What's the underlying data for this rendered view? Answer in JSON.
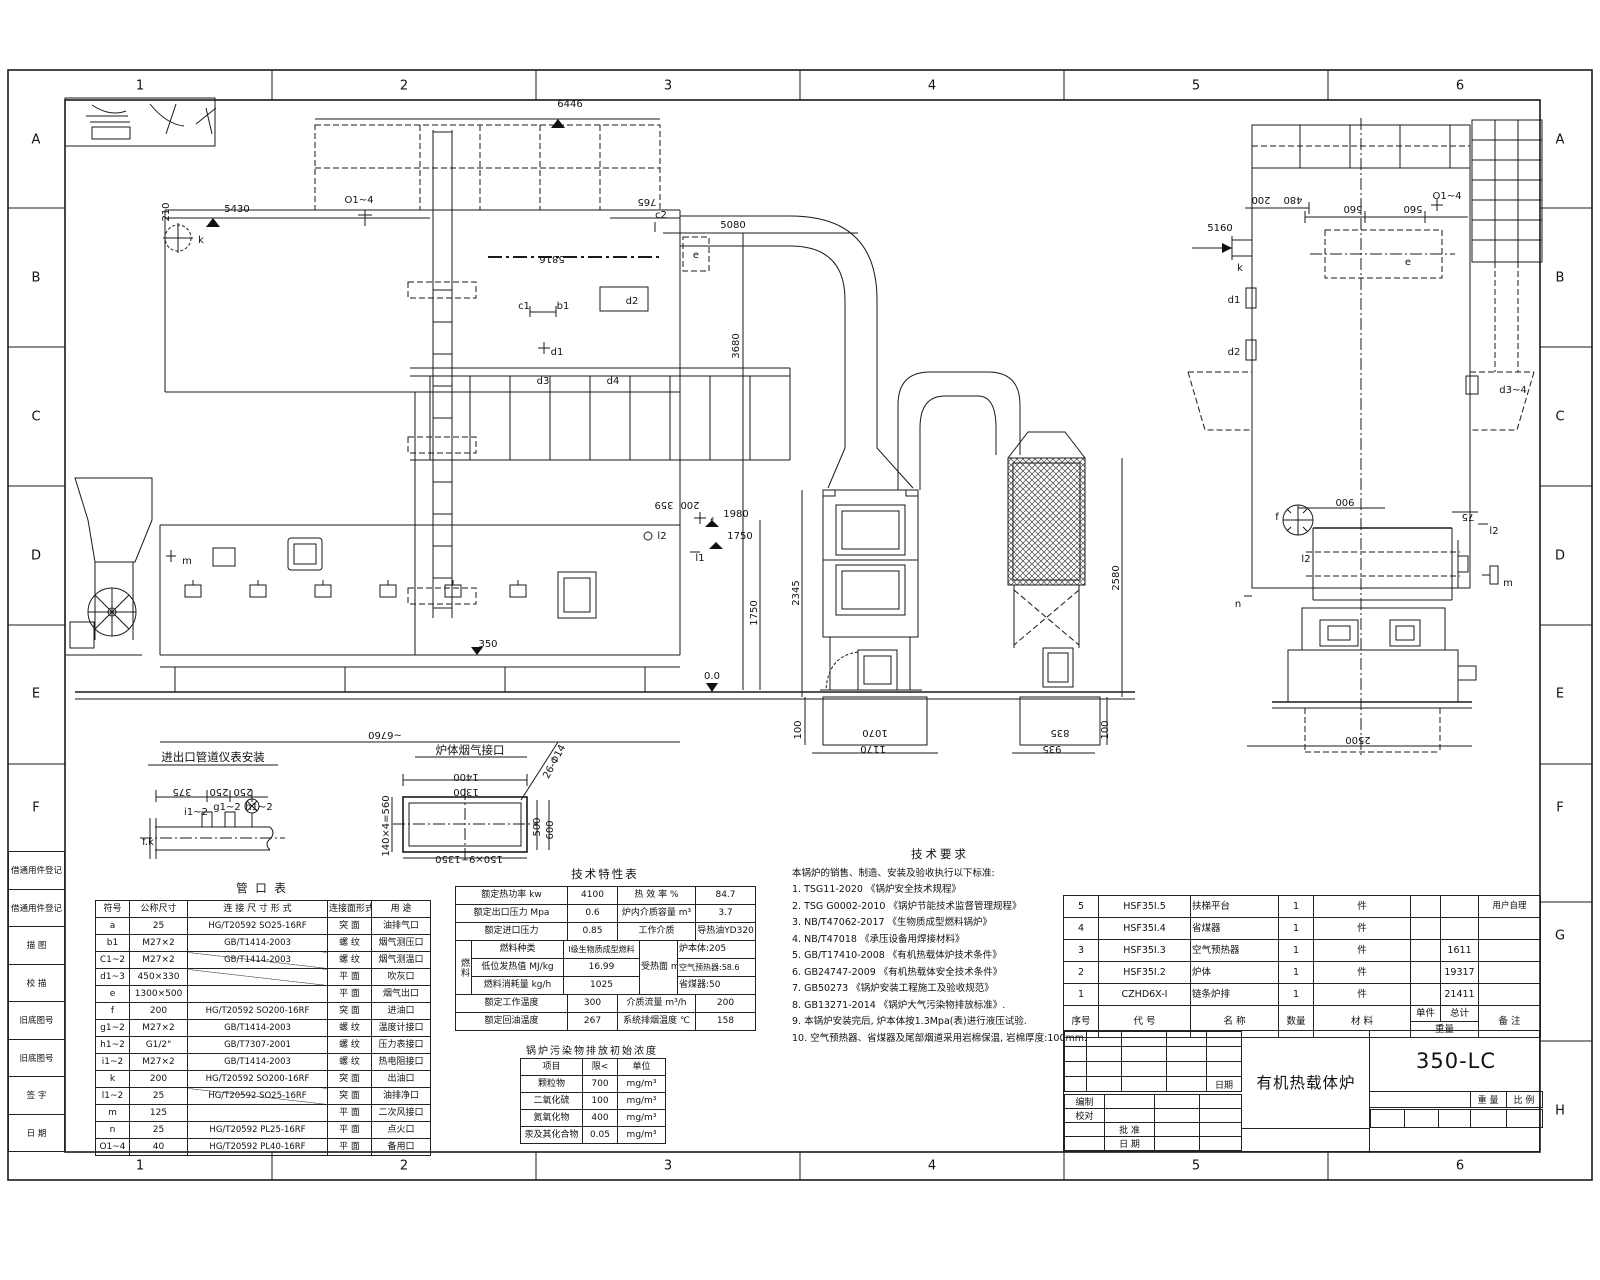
{
  "sheet": {
    "grid_cols": [
      "1",
      "2",
      "3",
      "4",
      "5",
      "6"
    ],
    "grid_rows_left": [
      "A",
      "B",
      "C",
      "D",
      "E",
      "F"
    ],
    "grid_rows_right": [
      "A",
      "B",
      "C",
      "D",
      "E",
      "F",
      "G",
      "H"
    ],
    "margin_fields": [
      "借通用件登记",
      "借通用件登记",
      "描  图",
      "校  描",
      "旧底图号",
      "旧底图号",
      "签  字",
      "日  期"
    ]
  },
  "pipe_table": {
    "title": "管  口  表",
    "headers": [
      "符号",
      "公称尺寸",
      "连 接 尺 寸 形 式",
      "连接面形式",
      "用  途"
    ],
    "rows": [
      [
        "a",
        "25",
        "HG/T20592 SO25-16RF",
        "突 面",
        "油排气口"
      ],
      [
        "b1",
        "M27×2",
        "GB/T1414-2003",
        "螺 纹",
        "烟气测压口"
      ],
      [
        "C1~2",
        "M27×2",
        "GB/T1414-2003",
        "螺 纹",
        "烟气测温口"
      ],
      [
        "d1~3",
        "450×330",
        "",
        "平 面",
        "吹灰口"
      ],
      [
        "e",
        "1300×500",
        "",
        "平 面",
        "烟气出口"
      ],
      [
        "f",
        "200",
        "HG/T20592 SO200-16RF",
        "突 面",
        "进油口"
      ],
      [
        "g1~2",
        "M27×2",
        "GB/T1414-2003",
        "螺 纹",
        "温度计接口"
      ],
      [
        "h1~2",
        "G1/2\"",
        "GB/T7307-2001",
        "螺 纹",
        "压力表接口"
      ],
      [
        "i1~2",
        "M27×2",
        "GB/T1414-2003",
        "螺 纹",
        "热电阻接口"
      ],
      [
        "k",
        "200",
        "HG/T20592 SO200-16RF",
        "突 面",
        "出油口"
      ],
      [
        "l1~2",
        "25",
        "HG/T20592 SO25-16RF",
        "突 面",
        "油排净口"
      ],
      [
        "m",
        "125",
        "",
        "平 面",
        "二次风接口"
      ],
      [
        "n",
        "25",
        "HG/T20592 PL25-16RF",
        "平 面",
        "点火口"
      ],
      [
        "O1~4",
        "40",
        "HG/T20592 PL40-16RF",
        "平 面",
        "备用口"
      ]
    ]
  },
  "spec_table": {
    "title": "技术特性表",
    "r1": [
      "额定热功率 kw",
      "4100",
      "热 效 率 %",
      "84.7"
    ],
    "r2": [
      "额定出口压力 Mpa",
      "0.6",
      "炉内介质容量 m³",
      "3.7"
    ],
    "r3": [
      "额定进口压力",
      "0.85",
      "工作介质",
      "导热油YD320"
    ],
    "fuel_label": "燃料",
    "f1": [
      "燃料种类",
      "I级生物质成型燃料"
    ],
    "f2": [
      "低位发热值 MJ/kg",
      "16.99"
    ],
    "f3": [
      "燃料消耗量 kg/h",
      "1025"
    ],
    "heat_label": "受热面 m²",
    "h1": "炉本体:205",
    "h2": "空气预热器:58.6",
    "h3": "省煤器:50",
    "r7": [
      "额定工作温度",
      "300",
      "介质流量 m³/h",
      "200"
    ],
    "r8": [
      "额定回油温度",
      "267",
      "系统排烟温度 ℃",
      "158"
    ]
  },
  "emission_table": {
    "title": "锅炉污染物排放初始浓度",
    "headers": [
      "项目",
      "限<",
      "单位"
    ],
    "rows": [
      [
        "颗粒物",
        "700",
        "mg/m³"
      ],
      [
        "二氧化硫",
        "100",
        "mg/m³"
      ],
      [
        "氮氧化物",
        "400",
        "mg/m³"
      ],
      [
        "汞及其化合物",
        "0.05",
        "mg/m³"
      ]
    ]
  },
  "tech_req": {
    "title": "技术要求",
    "intro": "本锅炉的销售、制造、安装及验收执行以下标准:",
    "items": [
      "1. TSG11-2020 《锅炉安全技术规程》",
      "2. TSG  G0002-2010 《锅炉节能技术监督管理规程》",
      "3. NB/T47062-2017 《生物质成型燃料锅炉》",
      "4. NB/T47018 《承压设备用焊接材料》",
      "5. GB/T17410-2008 《有机热载体炉技术条件》",
      "6. GB24747-2009 《有机热载体安全技术条件》",
      "7. GB50273 《锅炉安装工程施工及验收规范》",
      "8. GB13271-2014 《锅炉大气污染物排放标准》.",
      "9. 本锅炉安装完后, 炉本体按1.3Mpa(表)进行液压试验.",
      "10. 空气预热器、省煤器及尾部烟道采用岩棉保温, 岩棉厚度:100mm."
    ]
  },
  "bom": {
    "headers": {
      "seq": "序号",
      "code": "代    号",
      "name": "名    称",
      "qty": "数量",
      "material": "材    料",
      "unit": "单件",
      "total": "总计",
      "weight": "重量",
      "note": "备  注"
    },
    "rows": [
      [
        "5",
        "HSF35I.5",
        "扶梯平台",
        "1",
        "件",
        "",
        "",
        "用户自理"
      ],
      [
        "4",
        "HSF35I.4",
        "省煤器",
        "1",
        "件",
        "",
        "",
        ""
      ],
      [
        "3",
        "HSF35I.3",
        "空气预热器",
        "1",
        "件",
        "",
        "1611",
        ""
      ],
      [
        "2",
        "HSF35I.2",
        "炉体",
        "1",
        "件",
        "",
        "19317",
        ""
      ],
      [
        "1",
        "CZHD6X-I",
        "链条炉排",
        "1",
        "件",
        "",
        "21411",
        ""
      ]
    ]
  },
  "title_block": {
    "drawing_no": "350-LC",
    "product": "有机热载体炉",
    "weight": "重  量",
    "scale": "比  例",
    "date": "日期",
    "prepared": "编制",
    "checked": "校对",
    "approved": "批 准",
    "date2": "日 期"
  },
  "drawing": {
    "labels": {
      "d6446": "6446",
      "d5816": "5816",
      "d5430": "5430",
      "d210": "210",
      "d765": "765",
      "o14a": "O1~4",
      "kA": "k",
      "c2": "c2",
      "c1": "c1",
      "b1": "b1",
      "d2a": "d2",
      "d1a": "d1",
      "d3a": "d3",
      "d4a": "d4",
      "eA": "e",
      "d5080": "5080",
      "d3680": "3680",
      "d359": "359",
      "d200a": "200",
      "d1980": "1980",
      "d1750b": "1750",
      "fA": "f",
      "l1A": "l1",
      "l2A": "l2",
      "d1750a": "1750",
      "d2345": "2345",
      "d00": "0.0",
      "d350": "350",
      "mA": "m",
      "d6760": "~6760",
      "d2580": "2580",
      "d100a": "100",
      "d100b": "100",
      "d1070": "1070",
      "d835": "835",
      "d1170": "1170",
      "d935": "935",
      "d5160": "5160",
      "d200b": "200",
      "d480": "480",
      "d560a": "560",
      "d560b": "560",
      "o14b": "O1~4",
      "kB": "k",
      "eB": "e",
      "d1b": "d1",
      "d2b": "d2",
      "d34": "d3~4",
      "d900": "900",
      "d75": "75",
      "fB": "f",
      "l2B": "l2",
      "l2C": "l2",
      "mB": "m",
      "nB": "n",
      "d2500": "2500",
      "det1_title": "进出口管道仪表安装",
      "det2_title": "炉体烟气接口",
      "d375": "375",
      "d250a": "250",
      "d250b": "250",
      "i12": "i1~2",
      "g12": "g1~2",
      "h12": "h1~2",
      "fk": "f.k",
      "d1400": "1400",
      "d1300": "1300",
      "d140x": "140×4=560",
      "d150x": "150×9=1350",
      "d500": "500",
      "d600": "600",
      "d26": "26-Φ14"
    }
  }
}
